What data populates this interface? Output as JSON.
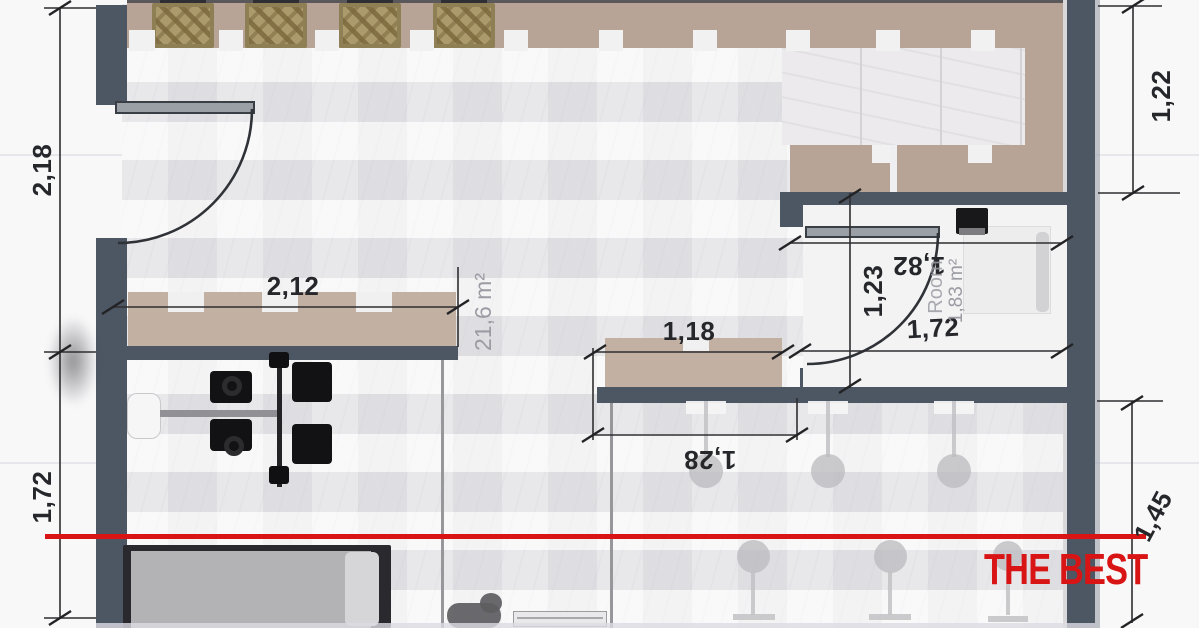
{
  "watermark": {
    "text": "THE BEST",
    "color": "#d81414"
  },
  "dimensions": {
    "left_wall_upper": "2,18",
    "left_wall_lower": "1,72",
    "right_wall_upper": "1,22",
    "right_wall_lower": "1,45",
    "left_counter_width": "2,12",
    "center_counter_width": "1,18",
    "bar_opening_width": "1,28",
    "wc_upper_width": "1,82",
    "wc_door_height": "1,23",
    "wc_lower_width": "1,72"
  },
  "rooms": {
    "main_area": "21,6 m²",
    "wc_name": "Room",
    "wc_area": "1,83 m²"
  },
  "colors": {
    "wall": "#4d5663",
    "counter": "#c2b1a3",
    "terrace": "#b7a496",
    "rug": "#ab9b6c",
    "marble_floor": "#e8e8ea",
    "accent_red": "#d81414",
    "dimension_text": "#26272b",
    "area_text": "#9b9ba3"
  }
}
